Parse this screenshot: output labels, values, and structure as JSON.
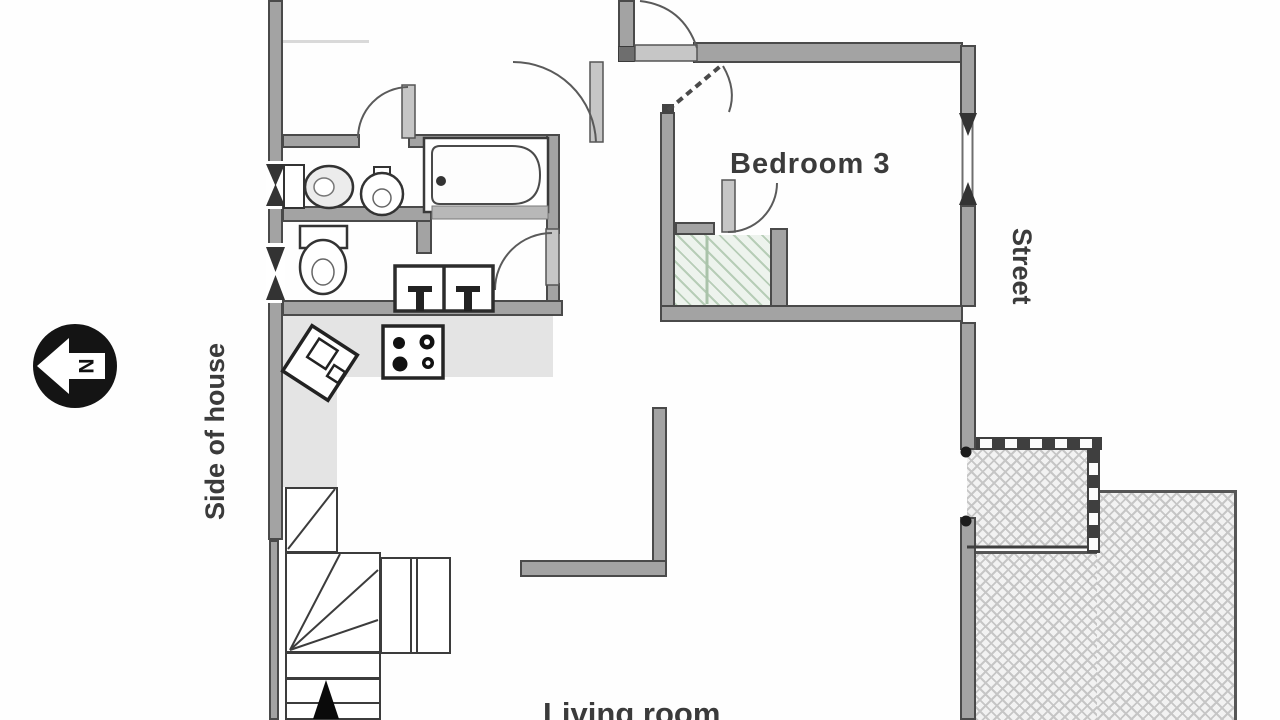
{
  "labels": {
    "bedroom3": "Bedroom 3",
    "street": "Street",
    "side_of_house": "Side of house",
    "living_room": "Living room",
    "compass_north": "N"
  },
  "colors": {
    "wall_fill": "#a3a3a3",
    "wall_edge": "#4a4a4a",
    "counter_fill": "#e4e4e4",
    "closet_hatch_bg": "#edf3ed",
    "closet_hatch_line": "#b7cdb7",
    "patio_hatch_line": "#c6c6c6",
    "railing_dark": "#3f3f3f",
    "label_text": "#3b3b3b",
    "fixture_line": "#2e2e2e",
    "compass_fill": "#141414"
  }
}
